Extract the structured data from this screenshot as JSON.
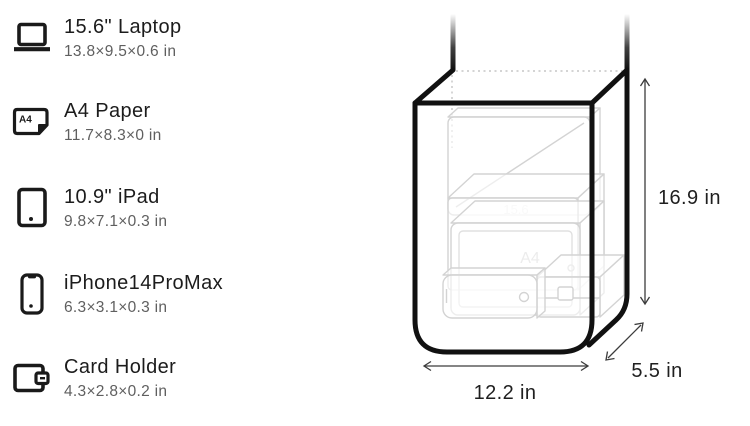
{
  "sidebar": {
    "items": [
      {
        "title": "15.6\" Laptop",
        "dimensions": "13.8×9.5×0.6 in",
        "icon": "laptop-icon"
      },
      {
        "title": "A4 Paper",
        "dimensions": "11.7×8.3×0 in",
        "icon": "a4-paper-icon",
        "icon_label": "A4"
      },
      {
        "title": "10.9\" iPad",
        "dimensions": "9.8×7.1×0.3 in",
        "icon": "ipad-icon"
      },
      {
        "title": "iPhone14ProMax",
        "dimensions": "6.3×3.1×0.3 in",
        "icon": "iphone-icon"
      },
      {
        "title": "Card Holder",
        "dimensions": "4.3×2.8×0.2 in",
        "icon": "card-holder-icon"
      }
    ]
  },
  "diagram": {
    "type": "bag-capacity-wireframe",
    "height_label": "16.9 in",
    "width_label": "12.2 in",
    "depth_label": "5.5 in",
    "inner_labels": {
      "laptop": "15.6",
      "a4_paper": "A4"
    },
    "colors": {
      "bag_outline": "#111111",
      "item_outline": "#d3d3d3",
      "dotted_edge": "#c5c5c5",
      "dimension_lines": "#3c3c3c",
      "dimension_text": "#1f1f1f",
      "background": "#ffffff"
    }
  }
}
